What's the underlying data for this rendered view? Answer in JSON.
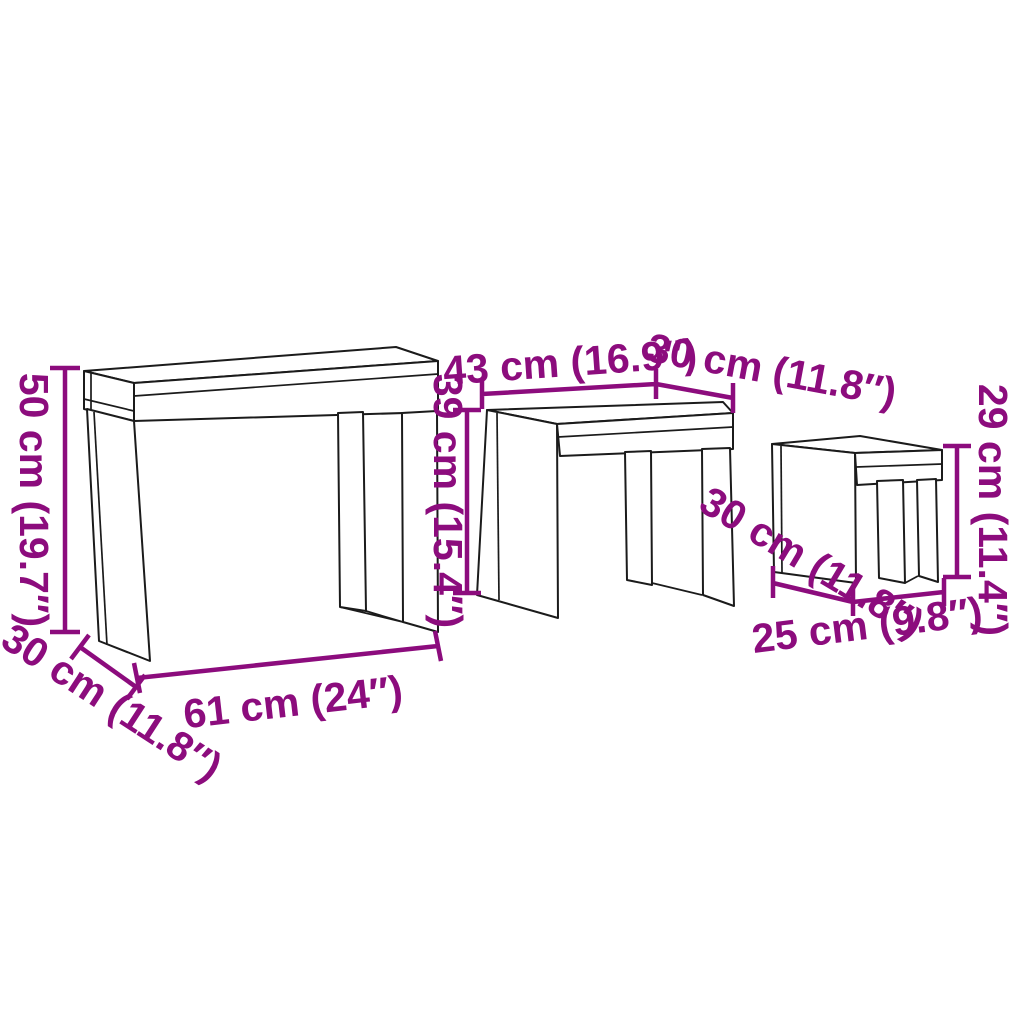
{
  "diagram": {
    "type": "product-dimension-diagram",
    "subject": "3 nesting tables line drawing",
    "background_color": "#ffffff",
    "outline_color": "#1b1b1b",
    "dimension_color": "#8C0C7D",
    "tables": [
      {
        "id": "large-table",
        "height_label": "50 cm (19.7″)",
        "width_label": "61 cm (24″)",
        "depth_label": "30 cm (11.8″)"
      },
      {
        "id": "medium-table",
        "height_label": "39 cm (15.4″)",
        "width_label": "43 cm (16.9″)",
        "depth_label": "30 cm (11.8″)"
      },
      {
        "id": "small-table",
        "height_label": "29 cm (11.4″)",
        "width_label": "25 cm (9.8″)",
        "depth_label": "30 cm (11.8″)"
      }
    ]
  }
}
